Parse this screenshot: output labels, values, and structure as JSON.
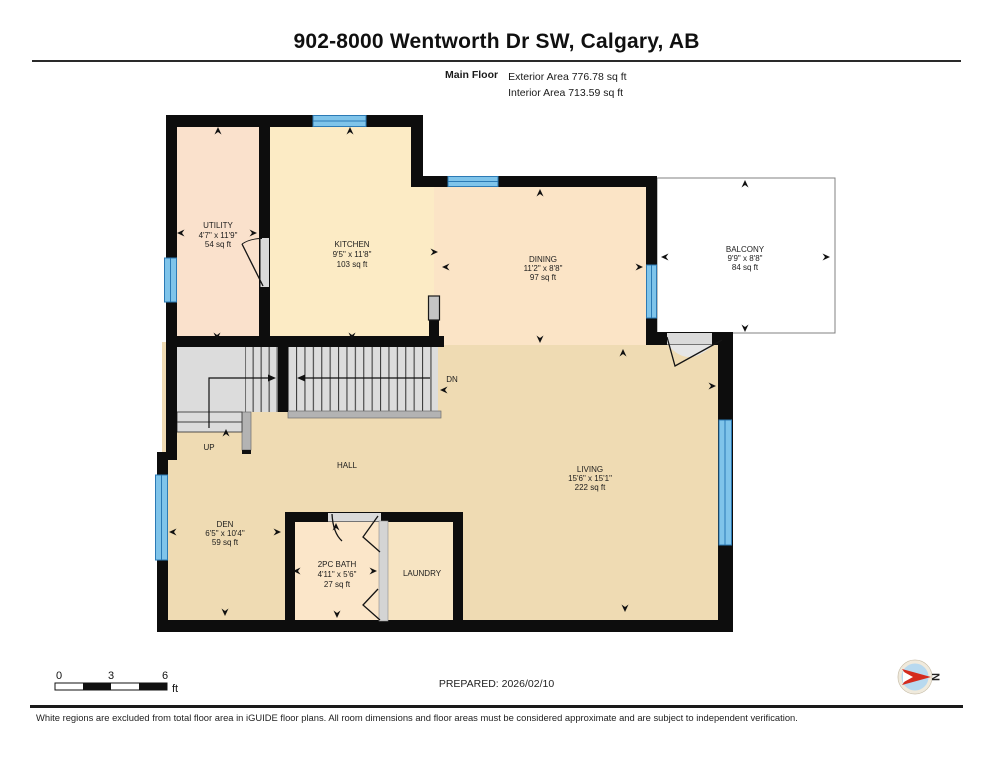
{
  "header": {
    "title": "902-8000 Wentworth Dr SW, Calgary, AB",
    "floor_label": "Main Floor",
    "exterior_area": "Exterior Area 776.78 sq ft",
    "interior_area": "Interior Area 713.59 sq ft"
  },
  "rooms": {
    "utility": {
      "name": "UTILITY",
      "dims": "4'7\" x 11'9\"",
      "area": "54 sq ft"
    },
    "kitchen": {
      "name": "KITCHEN",
      "dims": "9'5\" x 11'8\"",
      "area": "103 sq ft"
    },
    "dining": {
      "name": "DINING",
      "dims": "11'2\" x 8'8\"",
      "area": "97 sq ft"
    },
    "balcony": {
      "name": "BALCONY",
      "dims": "9'9\" x 8'8\"",
      "area": "84 sq ft"
    },
    "living": {
      "name": "LIVING",
      "dims": "15'6\" x 15'1\"",
      "area": "222 sq ft"
    },
    "den": {
      "name": "DEN",
      "dims": "6'5\" x 10'4\"",
      "area": "59 sq ft"
    },
    "bath": {
      "name": "2PC BATH",
      "dims": "4'11\" x 5'6\"",
      "area": "27 sq ft"
    },
    "laundry": {
      "name": "LAUNDRY"
    },
    "hall": {
      "name": "HALL"
    }
  },
  "stairs": {
    "up": "UP",
    "down": "DN"
  },
  "scale_bar": {
    "tick_0": "0",
    "tick_3": "3",
    "tick_6": "6",
    "unit": "ft"
  },
  "compass": {
    "label": "N"
  },
  "footer": {
    "prepared": "PREPARED: 2026/02/10",
    "disclaimer": "White regions are excluded from total floor area in iGUIDE floor plans. All room dimensions and floor areas must be considered approximate and are subject to independent verification."
  },
  "colors": {
    "wall": "#0d0d0d",
    "window": "#7FC4EA",
    "window_frame": "#2B7AB5",
    "utility_fill": "#FAE1CC",
    "kitchen_fill": "#FCEBC5",
    "dining_fill": "#FBE4C6",
    "living_fill": "#EFDBB3",
    "bath_fill": "#FBE6C9",
    "laundry_fill": "#F7E4C2",
    "stairs_fill": "#DCDCDC",
    "balcony_fill": "#FFFFFF",
    "compass_red": "#D42B1E"
  }
}
